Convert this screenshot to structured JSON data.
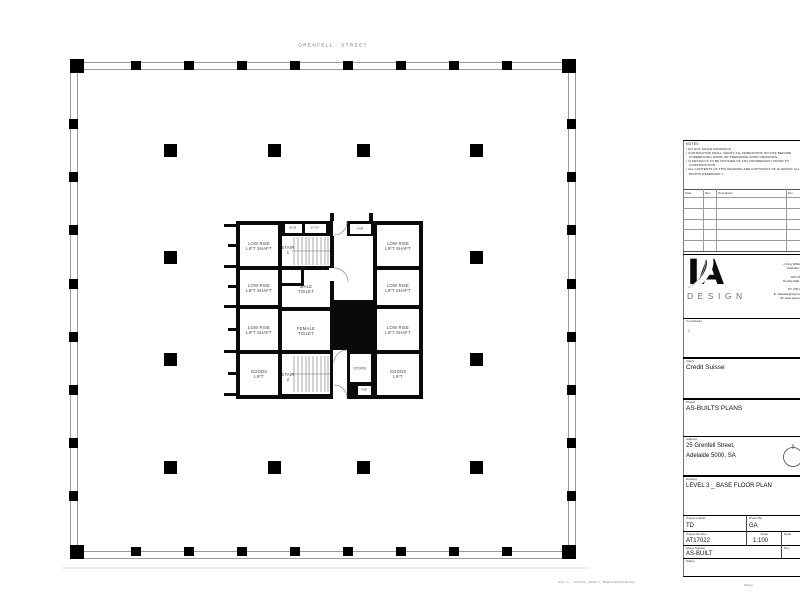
{
  "plan": {
    "street_label": "GRENFELL STREET",
    "rooms": {
      "low_rise_lift": {
        "line1": "LOW RISE",
        "line2": "LIFT SHAFT"
      },
      "goods_lift": {
        "line1": "GOODS",
        "line2": "LIFT"
      },
      "stair1": {
        "line1": "STAIR",
        "line2": "1"
      },
      "stair2": {
        "line1": "STAIR",
        "line2": "2"
      },
      "male_toilet": {
        "line1": "MALE",
        "line2": "TOILET"
      },
      "female_toilet": {
        "line1": "FEMALE",
        "line2": "TOILET"
      },
      "store": "STORE",
      "fhr": "FHR",
      "bcm": "BCM",
      "etsa": "ETSA"
    }
  },
  "titleblock": {
    "notes": {
      "heading": "NOTES",
      "items": [
        "DO NOT SCALE DRAWINGS.",
        "CONTRACTOR SHALL VERIFY ALL DIMENSIONS ON SITE BEFORE COMMENCING WORK OR PREPARING SHOP DRAWINGS.",
        "IA DESIGN IS TO BE NOTIFIED OF ANY DISCREPANCY PRIOR TO CONSTRUCTION.",
        "ALL CONTENTS OF THIS DRAWING ARE COPYRIGHT OF IA GROUP. ALL RIGHTS RESERVED ©"
      ]
    },
    "revision_table": {
      "headers": [
        "Date",
        "Rev",
        "Description",
        "Drn"
      ]
    },
    "logo": {
      "text": "IA",
      "subtext": "DESIGN"
    },
    "contact_lines": [
      "Lev",
      "2 King William St",
      "Adelaide SA 5",
      "",
      "GPO Box 2",
      "Rundle Mall SA 5",
      "",
      "Ph: (08) 8212",
      "E: adelaide@iagroup.co",
      "W: www.iagroup.co"
    ],
    "consultants": {
      "label": "Consultants",
      "value": "1"
    },
    "client": {
      "label": "Client",
      "value": "Credit Suisse"
    },
    "project": {
      "label": "Project",
      "value": "AS-BUILTS PLANS"
    },
    "address": {
      "label": "Address",
      "line1": "25 Grenfell Street,",
      "line2": "Adelaide 5000, SA"
    },
    "drawing": {
      "label": "Drawing",
      "value": "LEVEL 3 _ BASE FLOOR PLAN"
    },
    "fields": {
      "project_leader": {
        "label": "Project Leader",
        "value": "TD"
      },
      "drawn_by": {
        "label": "Drawn By",
        "value": "GA"
      },
      "project_number": {
        "label": "Project Number",
        "value": "AT17022"
      },
      "scale": {
        "label": "Scale",
        "value": "1:100"
      },
      "drawing_number": {
        "label": "Draw"
      },
      "sheet_number": {
        "label": "Sheet Number",
        "value": "AS-BUILT"
      },
      "revision": {
        "label": "Rev"
      },
      "status": {
        "label": "Status"
      }
    },
    "footnote": "Note:   C:\\ ... \\ AT17022 _ LEVEL 3 _ BASE FLOOR PLAN.dwg",
    "footnote_right": "Plotted"
  }
}
